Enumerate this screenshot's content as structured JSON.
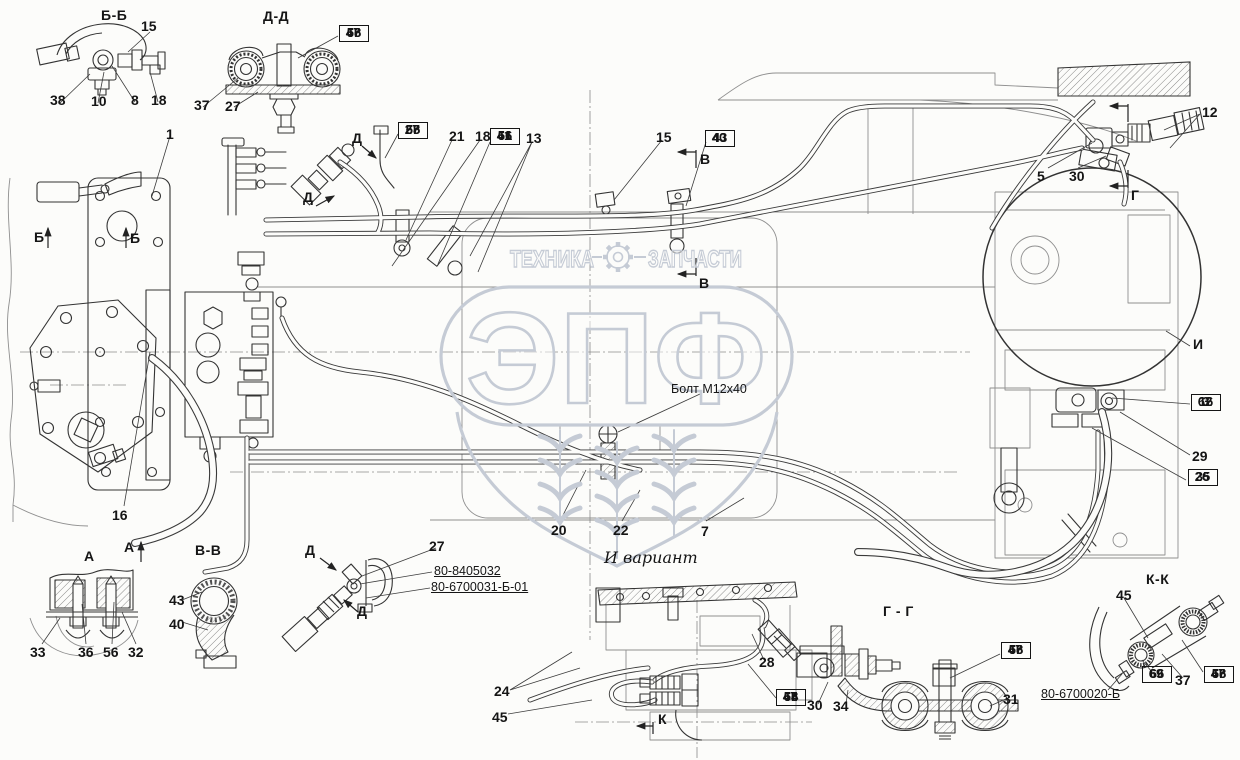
{
  "watermark": {
    "left_word": "ТЕХНИКА",
    "right_word": "ЗАПЧАСТИ",
    "shield_text": "ЭПФ",
    "color": "#c5cbd5"
  },
  "free_labels": [
    {
      "text": "Болт М12х40",
      "x": 671,
      "y": 383,
      "cls": "fl-small"
    },
    {
      "text": "И вариант",
      "x": 604,
      "y": 549,
      "cls": "fl-script"
    },
    {
      "text": "80-8405032",
      "x": 434,
      "y": 564,
      "cls": "fl-pn"
    },
    {
      "text": "80-6700031-Б-01",
      "x": 431,
      "y": 580,
      "cls": "fl-pn"
    },
    {
      "text": "80-6700020-Б",
      "x": 1041,
      "y": 687,
      "cls": "fl-pn"
    }
  ],
  "view_titles": [
    {
      "text": "Б-Б",
      "x": 101,
      "y": 8
    },
    {
      "text": "Д-Д",
      "x": 263,
      "y": 9
    },
    {
      "text": "А",
      "x": 84,
      "y": 549
    },
    {
      "text": "В-В",
      "x": 195,
      "y": 543
    },
    {
      "text": "Г - Г",
      "x": 883,
      "y": 604
    },
    {
      "text": "К-К",
      "x": 1146,
      "y": 572
    },
    {
      "text": "И",
      "x": 1193,
      "y": 337
    }
  ],
  "section_markers": [
    {
      "text": "Б",
      "x": 34,
      "y": 230
    },
    {
      "text": "Б",
      "x": 130,
      "y": 231
    },
    {
      "text": "В",
      "x": 700,
      "y": 152
    },
    {
      "text": "В",
      "x": 699,
      "y": 276
    },
    {
      "text": "Г",
      "x": 1131,
      "y": 188
    },
    {
      "text": "Д",
      "x": 352,
      "y": 131
    },
    {
      "text": "Д",
      "x": 303,
      "y": 190
    },
    {
      "text": "Д",
      "x": 305,
      "y": 543
    },
    {
      "text": "Д",
      "x": 357,
      "y": 604
    },
    {
      "text": "А",
      "x": 124,
      "y": 540
    },
    {
      "text": "К",
      "x": 658,
      "y": 712
    }
  ],
  "callouts": [
    {
      "text": "15",
      "x": 141,
      "y": 19
    },
    {
      "text": "38",
      "x": 50,
      "y": 93
    },
    {
      "text": "10",
      "x": 91,
      "y": 94
    },
    {
      "text": "8",
      "x": 131,
      "y": 93
    },
    {
      "text": "18",
      "x": 151,
      "y": 93
    },
    {
      "text": "37",
      "x": 194,
      "y": 98
    },
    {
      "text": "27",
      "x": 225,
      "y": 99
    },
    {
      "text": "1",
      "x": 166,
      "y": 127
    },
    {
      "text": "21",
      "x": 449,
      "y": 129
    },
    {
      "text": "18",
      "x": 475,
      "y": 129
    },
    {
      "text": "13",
      "x": 526,
      "y": 131
    },
    {
      "text": "15",
      "x": 656,
      "y": 130
    },
    {
      "text": "12",
      "x": 1202,
      "y": 105
    },
    {
      "text": "5",
      "x": 1037,
      "y": 169
    },
    {
      "text": "30",
      "x": 1069,
      "y": 169
    },
    {
      "text": "29",
      "x": 1192,
      "y": 449
    },
    {
      "text": "16",
      "x": 112,
      "y": 508
    },
    {
      "text": "20",
      "x": 551,
      "y": 523
    },
    {
      "text": "22",
      "x": 613,
      "y": 523
    },
    {
      "text": "7",
      "x": 701,
      "y": 524
    },
    {
      "text": "43",
      "x": 169,
      "y": 593
    },
    {
      "text": "40",
      "x": 169,
      "y": 617
    },
    {
      "text": "33",
      "x": 30,
      "y": 645
    },
    {
      "text": "36",
      "x": 78,
      "y": 645
    },
    {
      "text": "56",
      "x": 103,
      "y": 645
    },
    {
      "text": "32",
      "x": 128,
      "y": 645
    },
    {
      "text": "27",
      "x": 429,
      "y": 539
    },
    {
      "text": "24",
      "x": 494,
      "y": 684
    },
    {
      "text": "45",
      "x": 492,
      "y": 710
    },
    {
      "text": "28",
      "x": 759,
      "y": 655
    },
    {
      "text": "30",
      "x": 807,
      "y": 698
    },
    {
      "text": "34",
      "x": 833,
      "y": 699
    },
    {
      "text": "31",
      "x": 1003,
      "y": 692
    },
    {
      "text": "45",
      "x": 1116,
      "y": 588
    },
    {
      "text": "37",
      "x": 1175,
      "y": 673
    }
  ],
  "stacks": [
    {
      "x": 339,
      "y": 26,
      "items": [
        "47",
        "58",
        "66"
      ]
    },
    {
      "x": 398,
      "y": 123,
      "items": [
        "27",
        "55",
        "68"
      ]
    },
    {
      "x": 490,
      "y": 129,
      "items": [
        "41",
        "51",
        "66"
      ]
    },
    {
      "x": 705,
      "y": 131,
      "items": [
        "40",
        "43"
      ]
    },
    {
      "x": 1191,
      "y": 395,
      "items": [
        "62",
        "3",
        "16"
      ]
    },
    {
      "x": 1188,
      "y": 470,
      "items": [
        "26",
        "35"
      ]
    },
    {
      "x": 776,
      "y": 690,
      "items": [
        "47",
        "58",
        "66",
        "64"
      ]
    },
    {
      "x": 1001,
      "y": 643,
      "items": [
        "47",
        "58",
        "66"
      ]
    },
    {
      "x": 1142,
      "y": 667,
      "items": [
        "69",
        "66"
      ]
    },
    {
      "x": 1204,
      "y": 667,
      "items": [
        "47",
        "58",
        "66"
      ]
    }
  ]
}
